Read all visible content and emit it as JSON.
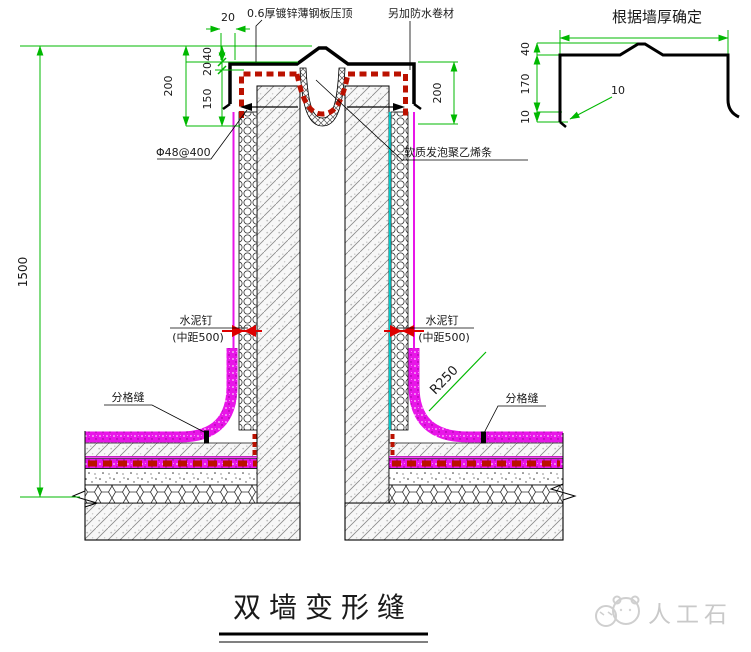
{
  "main_drawing": {
    "labels": {
      "coping": "0.6厚镀锌薄钢板压顶",
      "membrane": "另加防水卷材",
      "anchor": "Φ48@400",
      "foam_strip": "软质发泡聚乙烯条",
      "nail_left_title": "水泥钉",
      "nail_left_spacing": "(中距500)",
      "nail_right_title": "水泥钉",
      "nail_right_spacing": "(中距500)",
      "joint_left": "分格缝",
      "joint_right": "分格缝",
      "radius": "R250"
    },
    "dimensions": {
      "top_20": "20",
      "cap_40": "40",
      "cap_20": "20",
      "cap_150": "150",
      "cap_200": "200",
      "right_200": "200",
      "wall_1500": "1500"
    }
  },
  "profile_drawing": {
    "title": "根据墙厚确定",
    "dimensions": {
      "d40": "40",
      "d170": "170",
      "d10_side": "10",
      "d10_hook": "10"
    }
  },
  "footer": {
    "title": "双墙变形缝"
  },
  "watermark": {
    "text": "人工石"
  },
  "colors": {
    "dimension_green": "#00b800",
    "membrane_magenta": "#e816e8",
    "membrane_red": "#bb1100",
    "separation_cyan": "#00cccc"
  }
}
